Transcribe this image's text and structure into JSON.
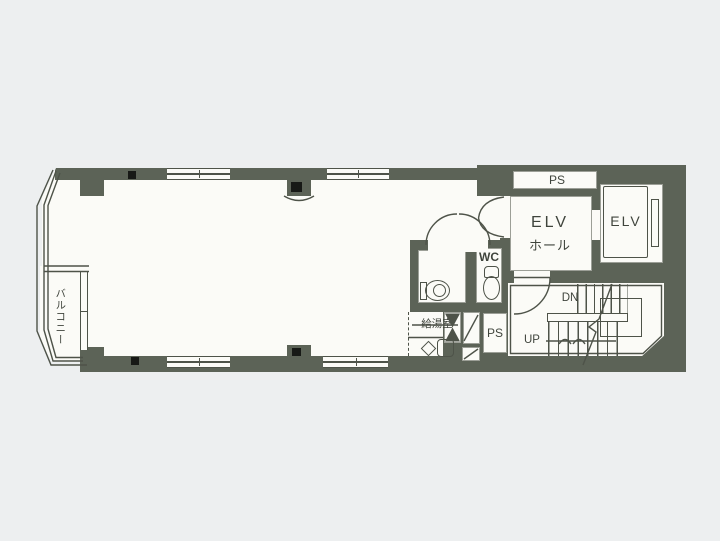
{
  "meta": {
    "kind": "building-floor-plan-scan"
  },
  "colors": {
    "background": "#edeff0",
    "paper": "#fbfbf7",
    "wall": "#5c6357",
    "line": "#4e5349",
    "ink": "#3f443c"
  },
  "labels": {
    "pipe_space_top": "PS",
    "elevator_hall_line1": "ELV",
    "elevator_hall_line2": "ホール",
    "elevator_car": "ELV",
    "toilet": "WC",
    "stairs_down": "DN",
    "stairs_up": "UP",
    "pipe_space_bottom": "PS",
    "kitchenette": "給湯室",
    "balcony": "バルコニー"
  }
}
